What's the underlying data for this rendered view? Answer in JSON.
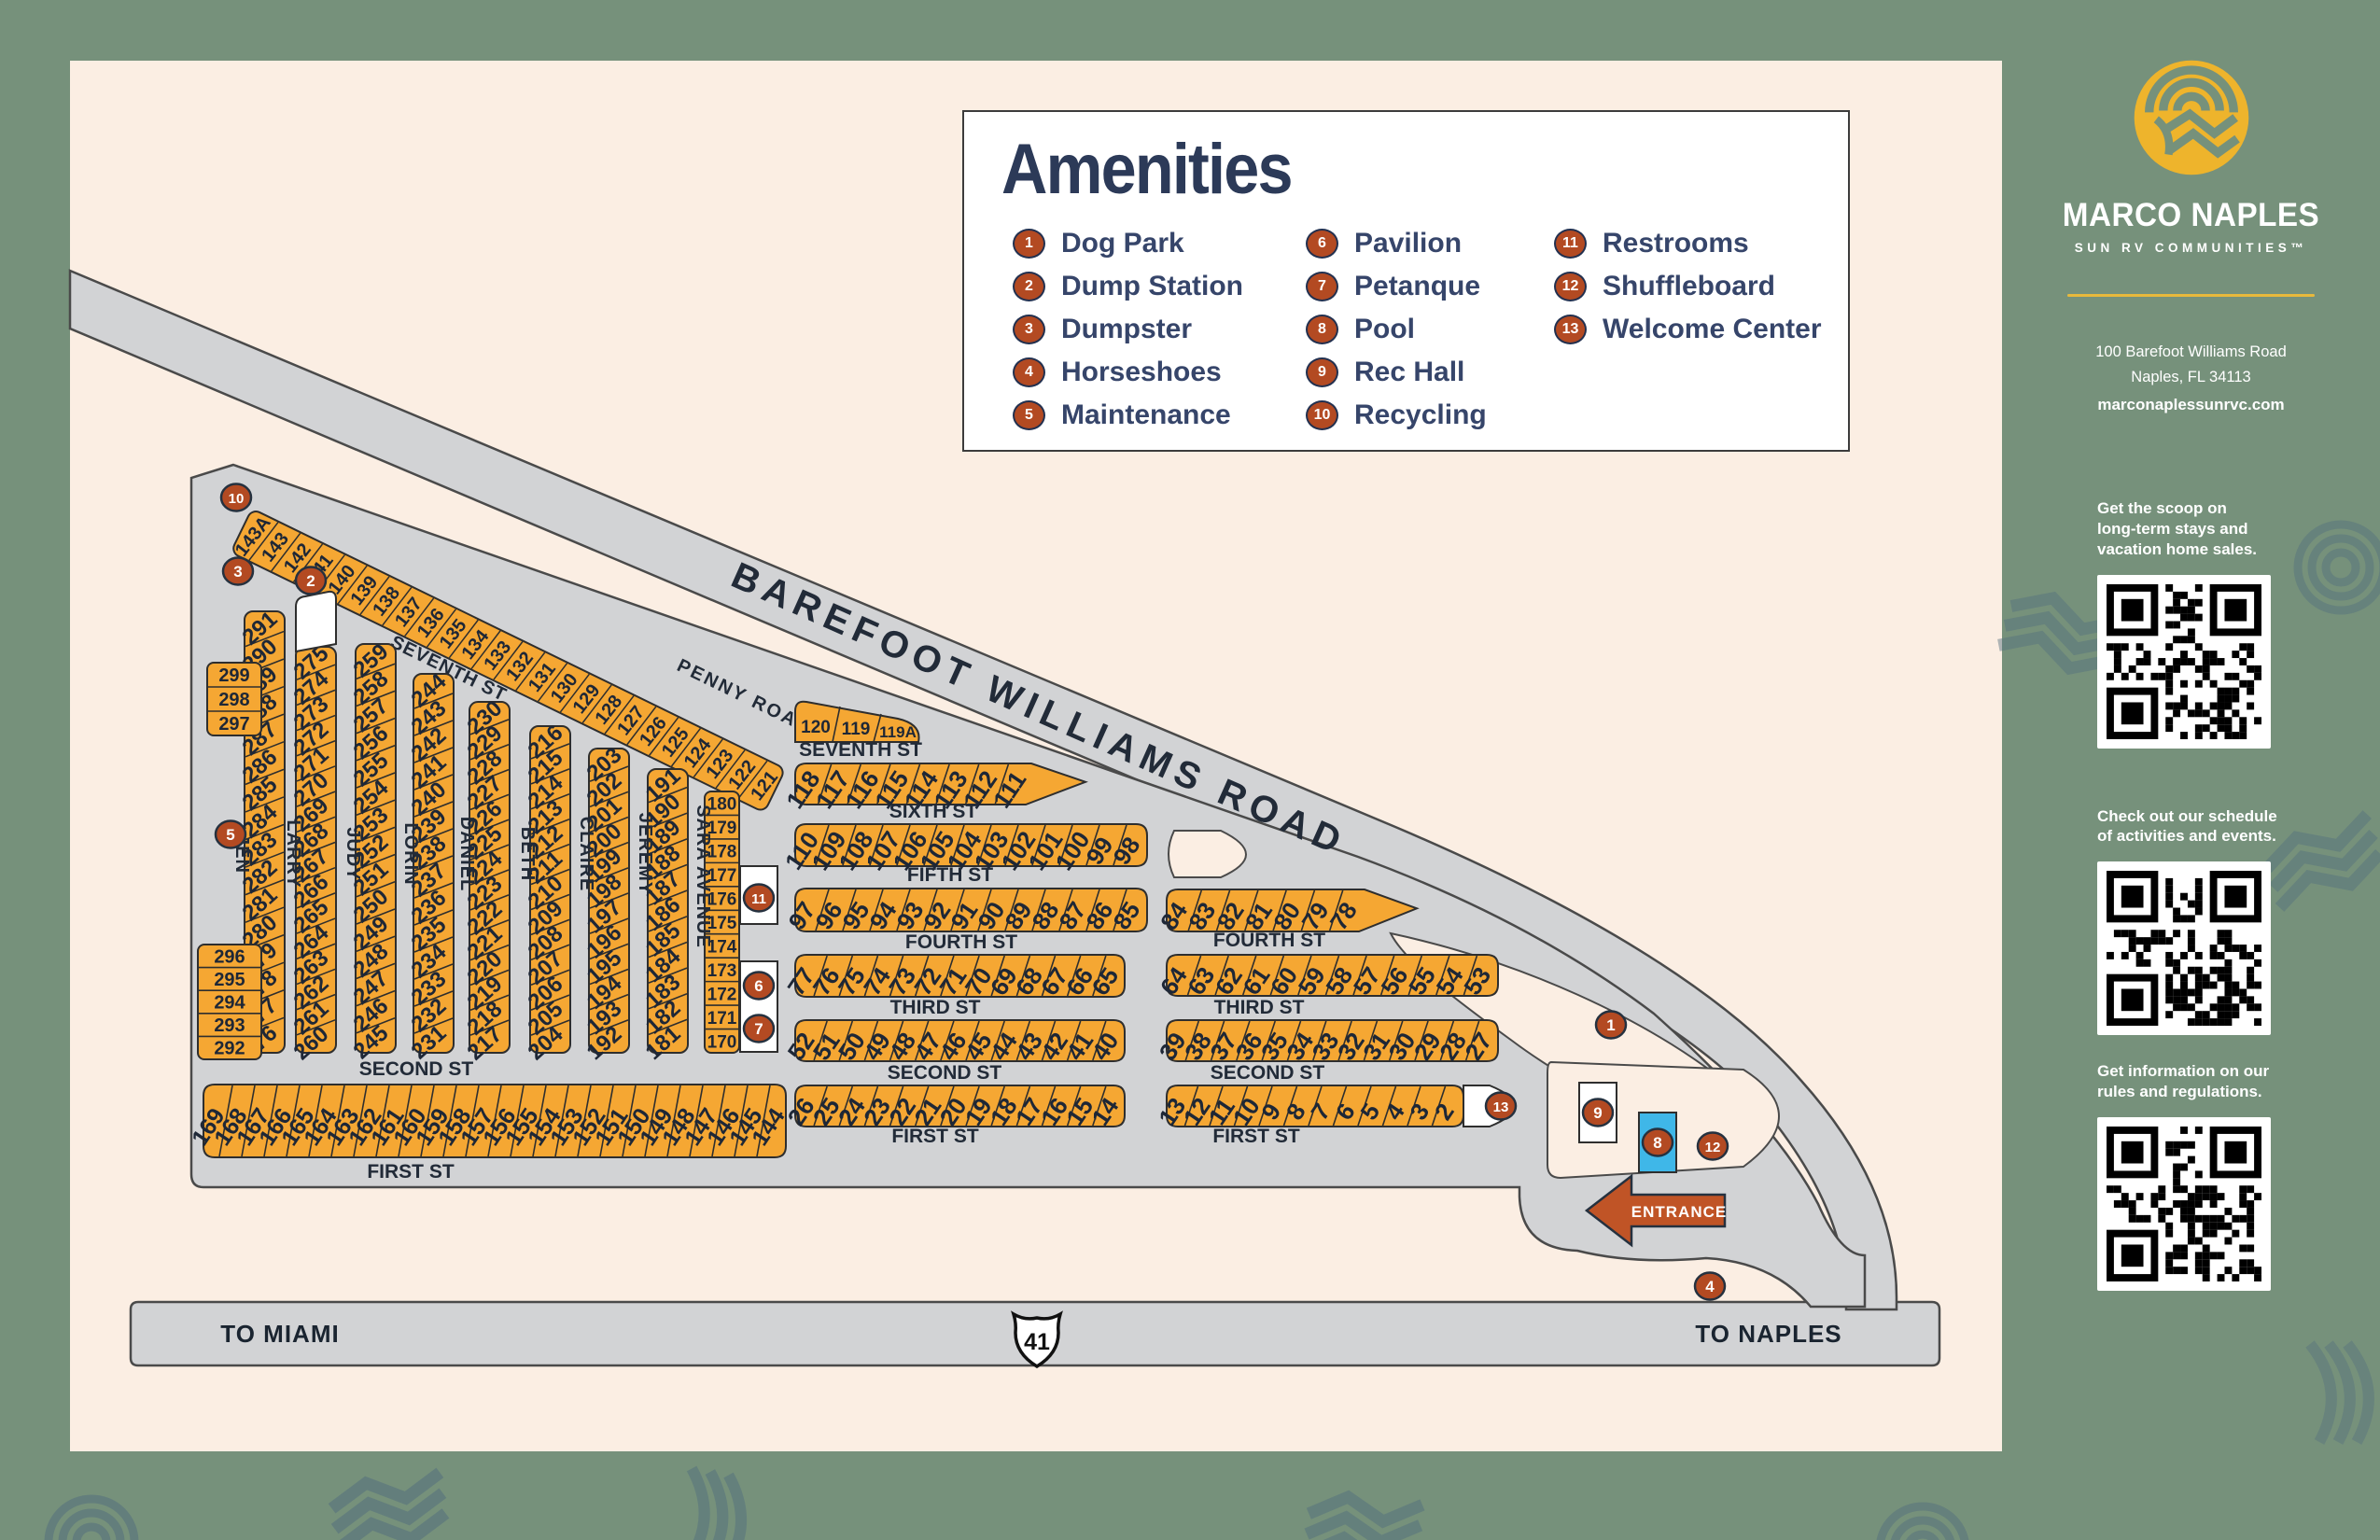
{
  "legend": {
    "title": "Amenities",
    "items": [
      {
        "num": "1",
        "label": "Dog Park"
      },
      {
        "num": "2",
        "label": "Dump Station"
      },
      {
        "num": "3",
        "label": "Dumpster"
      },
      {
        "num": "4",
        "label": "Horseshoes"
      },
      {
        "num": "5",
        "label": "Maintenance"
      },
      {
        "num": "6",
        "label": "Pavilion"
      },
      {
        "num": "7",
        "label": "Petanque"
      },
      {
        "num": "8",
        "label": "Pool"
      },
      {
        "num": "9",
        "label": "Rec Hall"
      },
      {
        "num": "10",
        "label": "Recycling"
      },
      {
        "num": "11",
        "label": "Restrooms"
      },
      {
        "num": "12",
        "label": "Shuffleboard"
      },
      {
        "num": "13",
        "label": "Welcome Center"
      }
    ],
    "column_breaks": [
      5,
      10,
      13
    ]
  },
  "sidebar": {
    "brand_name": "MARCO NAPLES",
    "brand_tagline": "SUN RV COMMUNITIES™",
    "address_line1": "100 Barefoot Williams Road",
    "address_line2": "Naples, FL  34113",
    "website": "marconaplessunrvc.com",
    "sections": [
      {
        "lines": [
          "Get the scoop on",
          "long-term stays and",
          "vacation home sales."
        ]
      },
      {
        "lines": [
          "Check out our schedule",
          "of activities and events."
        ]
      },
      {
        "lines": [
          "Get information on our",
          "rules and regulations."
        ]
      }
    ]
  },
  "map": {
    "roads": {
      "main_road": "BAREFOOT WILLIAMS ROAD",
      "penny_road": "PENNY ROAD",
      "seventh_diag": "SEVENTH ST"
    },
    "highway": {
      "left_label": "TO MIAMI",
      "shield": "41",
      "right_label": "TO NAPLES"
    },
    "entrance_label": "ENTRANCE",
    "top_strip_lots": [
      "143A",
      "143",
      "142",
      "141",
      "140",
      "139",
      "138",
      "137",
      "136",
      "135",
      "134",
      "133",
      "132",
      "131",
      "130",
      "129",
      "128",
      "127",
      "126",
      "125",
      "124",
      "123",
      "122",
      "121"
    ],
    "columns": [
      {
        "street": "JEN",
        "lots": [
          "291",
          "290",
          "289",
          "288",
          "287",
          "286",
          "285",
          "284",
          "283",
          "282",
          "281",
          "280",
          "279",
          "278",
          "277",
          "276"
        ]
      },
      {
        "street": "LARRY",
        "lots": [
          "275",
          "274",
          "273",
          "272",
          "271",
          "270",
          "269",
          "268",
          "267",
          "266",
          "265",
          "264",
          "263",
          "262",
          "261",
          "260"
        ]
      },
      {
        "street": "JUDY",
        "lots": [
          "259",
          "258",
          "257",
          "256",
          "255",
          "254",
          "253",
          "252",
          "251",
          "250",
          "249",
          "248",
          "247",
          "246",
          "245"
        ]
      },
      {
        "street": "LORIN",
        "lots": [
          "244",
          "243",
          "242",
          "241",
          "240",
          "239",
          "238",
          "237",
          "236",
          "235",
          "234",
          "233",
          "232",
          "231"
        ]
      },
      {
        "street": "DANIEL",
        "lots": [
          "230",
          "229",
          "228",
          "227",
          "226",
          "225",
          "224",
          "223",
          "222",
          "221",
          "220",
          "219",
          "218",
          "217"
        ]
      },
      {
        "street": "BETH",
        "lots": [
          "216",
          "215",
          "214",
          "213",
          "212",
          "211",
          "210",
          "209",
          "208",
          "207",
          "206",
          "205",
          "204"
        ]
      },
      {
        "street": "CLAIRE",
        "lots": [
          "203",
          "202",
          "201",
          "200",
          "199",
          "198",
          "197",
          "196",
          "195",
          "194",
          "193",
          "192"
        ]
      },
      {
        "street": "JEREMY",
        "lots": [
          "191",
          "190",
          "189",
          "188",
          "187",
          "186",
          "185",
          "184",
          "183",
          "182",
          "181"
        ]
      },
      {
        "street": "SARA AVENUE",
        "lots": [
          "180",
          "179",
          "178",
          "177",
          "176",
          "175",
          "174",
          "173",
          "172",
          "171",
          "170"
        ]
      }
    ],
    "left_block_upper": [
      "299",
      "298",
      "297"
    ],
    "left_block_lower": [
      "296",
      "295",
      "294",
      "293",
      "292"
    ],
    "penny_block": [
      "120",
      "119",
      "119A"
    ],
    "middle_rows": [
      {
        "lots": [
          "118",
          "117",
          "116",
          "115",
          "114",
          "113",
          "112",
          "111"
        ]
      },
      {
        "lots": [
          "110",
          "109",
          "108",
          "107",
          "106",
          "105",
          "104",
          "103",
          "102",
          "101",
          "100",
          "99",
          "98"
        ]
      },
      {
        "lots": [
          "97",
          "96",
          "95",
          "94",
          "93",
          "92",
          "91",
          "90",
          "89",
          "88",
          "87",
          "86",
          "85"
        ]
      },
      {
        "lots": [
          "77",
          "76",
          "75",
          "74",
          "73",
          "72",
          "71",
          "70",
          "69",
          "68",
          "67",
          "66",
          "65"
        ]
      },
      {
        "lots": [
          "52",
          "51",
          "50",
          "49",
          "48",
          "47",
          "46",
          "45",
          "44",
          "43",
          "42",
          "41",
          "40"
        ]
      },
      {
        "lots": [
          "26",
          "25",
          "24",
          "23",
          "22",
          "21",
          "20",
          "19",
          "18",
          "17",
          "16",
          "15",
          "14"
        ]
      }
    ],
    "middle_streets": [
      "SEVENTH ST",
      "SIXTH ST",
      "FIFTH ST",
      "FOURTH ST",
      "THIRD ST",
      "SECOND ST",
      "FIRST ST"
    ],
    "right_rows": [
      {
        "lots": [
          "84",
          "83",
          "82",
          "81",
          "80",
          "79",
          "78"
        ]
      },
      {
        "lots": [
          "64",
          "63",
          "62",
          "61",
          "60",
          "59",
          "58",
          "57",
          "56",
          "55",
          "54",
          "53"
        ]
      },
      {
        "lots": [
          "39",
          "38",
          "37",
          "36",
          "35",
          "34",
          "33",
          "32",
          "31",
          "30",
          "29",
          "28",
          "27"
        ]
      },
      {
        "lots": [
          "13",
          "12",
          "11",
          "10",
          "9",
          "8",
          "7",
          "6",
          "5",
          "4",
          "3",
          "2"
        ]
      }
    ],
    "right_streets": [
      "FOURTH ST",
      "THIRD ST",
      "SECOND ST",
      "FIRST ST"
    ],
    "first_st_row": [
      "169",
      "168",
      "167",
      "166",
      "165",
      "164",
      "163",
      "162",
      "161",
      "160",
      "159",
      "158",
      "157",
      "156",
      "155",
      "154",
      "153",
      "152",
      "151",
      "150",
      "149",
      "148",
      "147",
      "146",
      "145",
      "144"
    ],
    "left_streets": [
      "SECOND ST",
      "FIRST ST"
    ],
    "markers": [
      {
        "num": "10",
        "name": "recycling"
      },
      {
        "num": "3",
        "name": "dumpster"
      },
      {
        "num": "2",
        "name": "dump-station"
      },
      {
        "num": "5",
        "name": "maintenance"
      },
      {
        "num": "11",
        "name": "restrooms"
      },
      {
        "num": "6",
        "name": "pavilion"
      },
      {
        "num": "7",
        "name": "petanque"
      },
      {
        "num": "1",
        "name": "dog-park"
      },
      {
        "num": "13",
        "name": "welcome-center"
      },
      {
        "num": "9",
        "name": "rec-hall"
      },
      {
        "num": "8",
        "name": "pool"
      },
      {
        "num": "12",
        "name": "shuffleboard"
      },
      {
        "num": "4",
        "name": "horseshoes"
      }
    ],
    "colors": {
      "lot_yellow": "#f5a733",
      "road_gray": "#d2d3d5",
      "cream": "#fbeee3",
      "frame_green": "#76917b",
      "marker_rust": "#b34a22",
      "navy": "#2c3a58",
      "pool_blue": "#3fb7e8",
      "arrow_rust": "#c05426"
    }
  }
}
